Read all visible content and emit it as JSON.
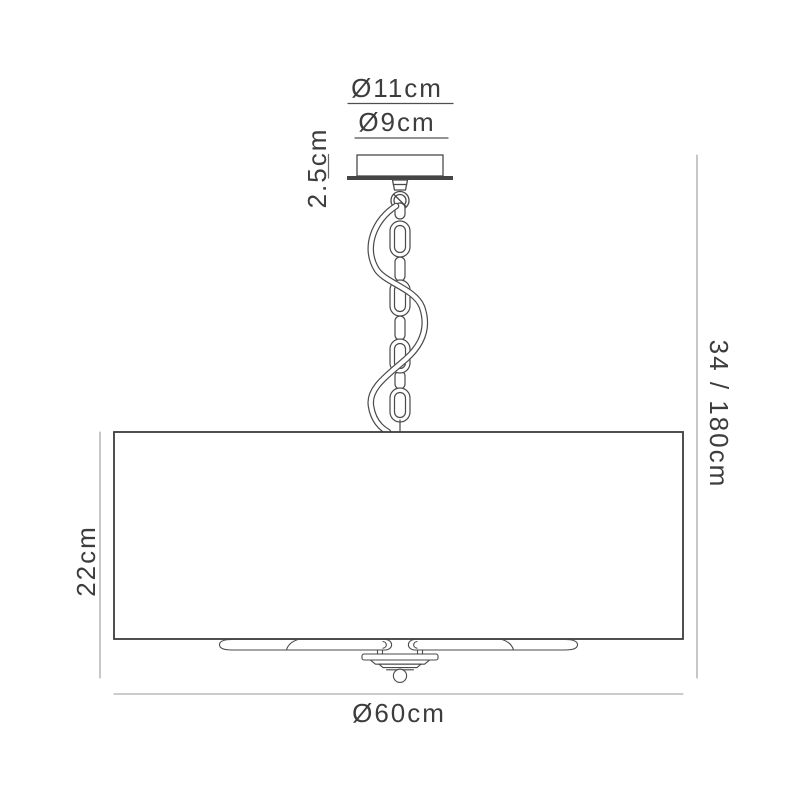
{
  "diagram": {
    "type": "product-dimension-drawing",
    "subject": "ceiling pendant light with chain suspension and drum shade",
    "labels": {
      "canopy_outer_diameter": "Ø11cm",
      "canopy_inner_diameter": "Ø9cm",
      "canopy_height": "2.5cm",
      "suspension_drop": "34 / 180cm",
      "shade_height": "22cm",
      "shade_diameter": "Ø60cm"
    },
    "colors": {
      "outline": "#4a4a4a",
      "shade_outline": "#3c3c3c",
      "dimension_line": "#999999",
      "dimension_line_dark": "#4f4f4f",
      "label_text": "#3d3d3d",
      "background": "#ffffff"
    }
  }
}
